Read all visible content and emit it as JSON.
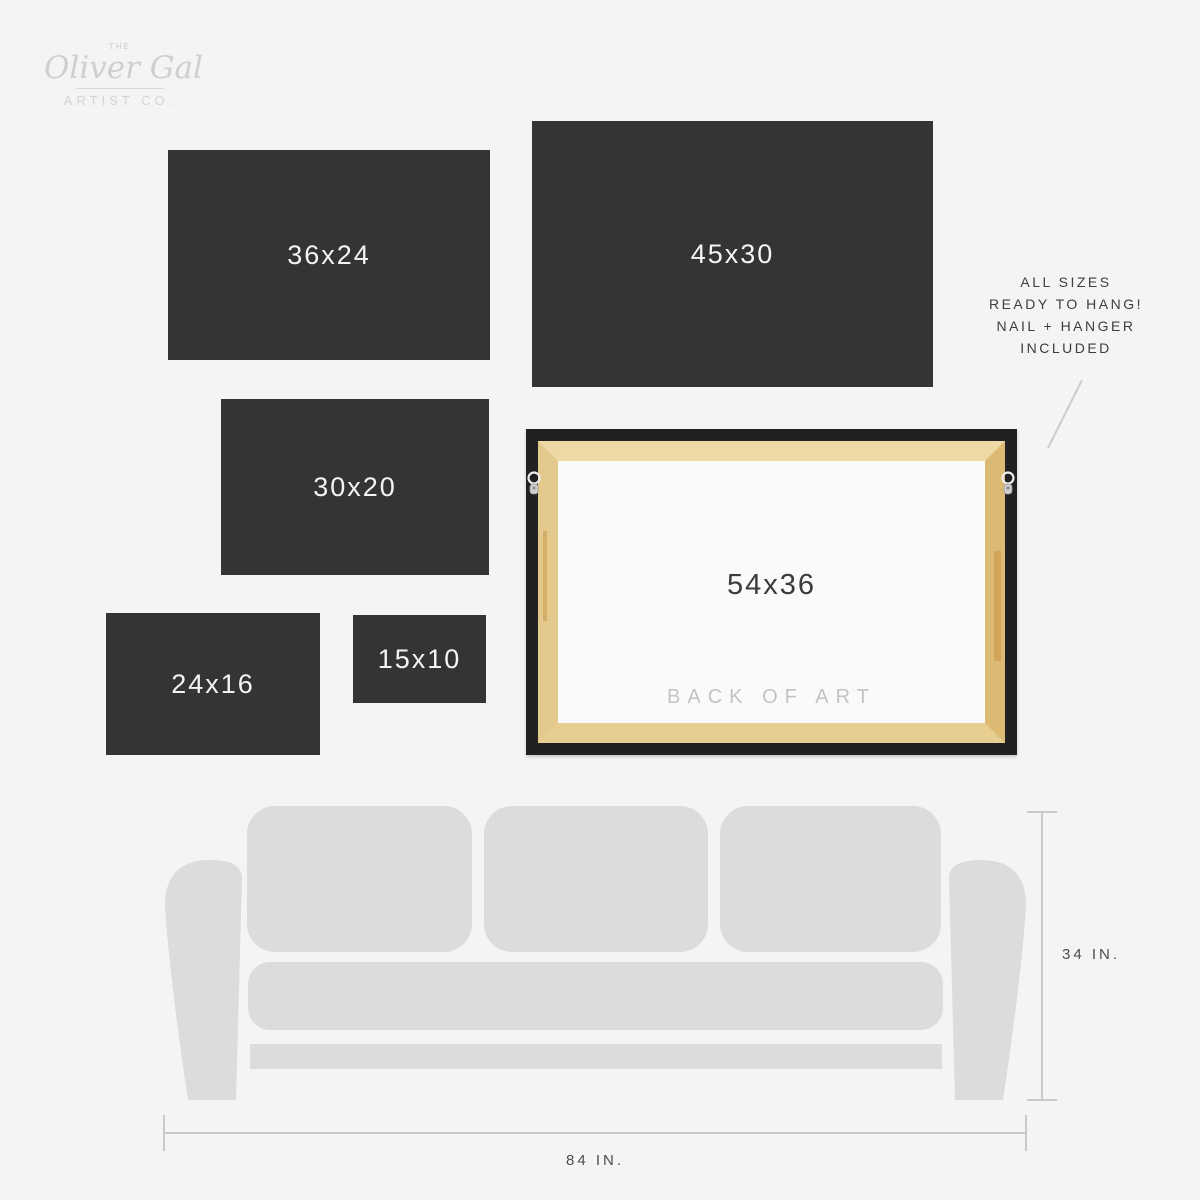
{
  "brand": {
    "prefix": "THE",
    "name": "Oliver Gal",
    "suffix": "ARTIST CO."
  },
  "size_boxes": [
    {
      "label": "36x24",
      "width_in": 36,
      "height_in": 24
    },
    {
      "label": "45x30",
      "width_in": 45,
      "height_in": 30
    },
    {
      "label": "30x20",
      "width_in": 30,
      "height_in": 20
    },
    {
      "label": "24x16",
      "width_in": 24,
      "height_in": 16
    },
    {
      "label": "15x10",
      "width_in": 15,
      "height_in": 10
    }
  ],
  "frame": {
    "size_label": "54x36",
    "back_label": "BACK OF ART",
    "width_in": 54,
    "height_in": 36
  },
  "note": {
    "lines": [
      "ALL SIZES",
      "READY TO HANG!",
      "NAIL + HANGER",
      "INCLUDED"
    ]
  },
  "sofa": {
    "height_label": "34 IN.",
    "width_label": "84 IN."
  },
  "colors": {
    "background": "#f4f4f4",
    "size_box": "#343437",
    "size_box_text": "#f4f4f4",
    "frame_border": "#212124",
    "wood": "#e8cf94",
    "sofa": "#dcdcdc",
    "dim_line": "#c9c9c9",
    "note_text": "#3e3e3e",
    "logo_text": "#d2d2d2",
    "back_label_text": "#c3c3c3"
  }
}
